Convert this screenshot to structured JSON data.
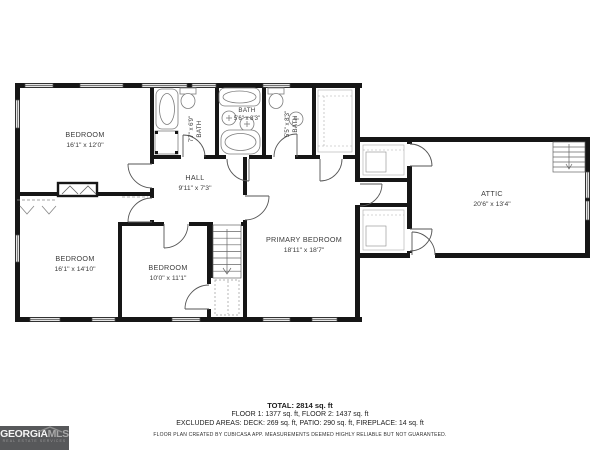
{
  "plan": {
    "rooms": [
      {
        "name": "BEDROOM",
        "dims": "16'1\" x 12'0\""
      },
      {
        "name": "BATH",
        "dims": "7'7\" x 6'9\""
      },
      {
        "name": "BATH",
        "dims": "5'6\" x 8'3\""
      },
      {
        "name": "BATH",
        "dims": "5'5\" x 8'3\""
      },
      {
        "name": "HALL",
        "dims": "9'11\" x 7'3\""
      },
      {
        "name": "BEDROOM",
        "dims": "16'1\" x 14'10\""
      },
      {
        "name": "BEDROOM",
        "dims": "10'0\" x 11'1\""
      },
      {
        "name": "PRIMARY BEDROOM",
        "dims": "18'11\" x 18'7\""
      },
      {
        "name": "ATTIC",
        "dims": "20'6\" x 13'4\""
      }
    ]
  },
  "summary": {
    "total": "TOTAL: 2814 sq. ft",
    "floors": "FLOOR 1: 1377 sq. ft, FLOOR 2: 1437 sq. ft",
    "excluded": "EXCLUDED AREAS: DECK: 269 sq. ft, PATIO: 290 sq. ft, FIREPLACE: 14 sq. ft",
    "disclaimer": "FLOOR PLAN CREATED BY CUBICASA APP. MEASUREMENTS DEEMED HIGHLY RELIABLE BUT NOT GUARANTEED."
  },
  "logo": {
    "brand_primary": "GEORGIA",
    "brand_secondary": "MLS",
    "tagline": "REAL ESTATE SERVICES"
  },
  "colors": {
    "wall": "#161616",
    "fixture": "#7d7d7d",
    "logo_bg": "#57585a"
  }
}
